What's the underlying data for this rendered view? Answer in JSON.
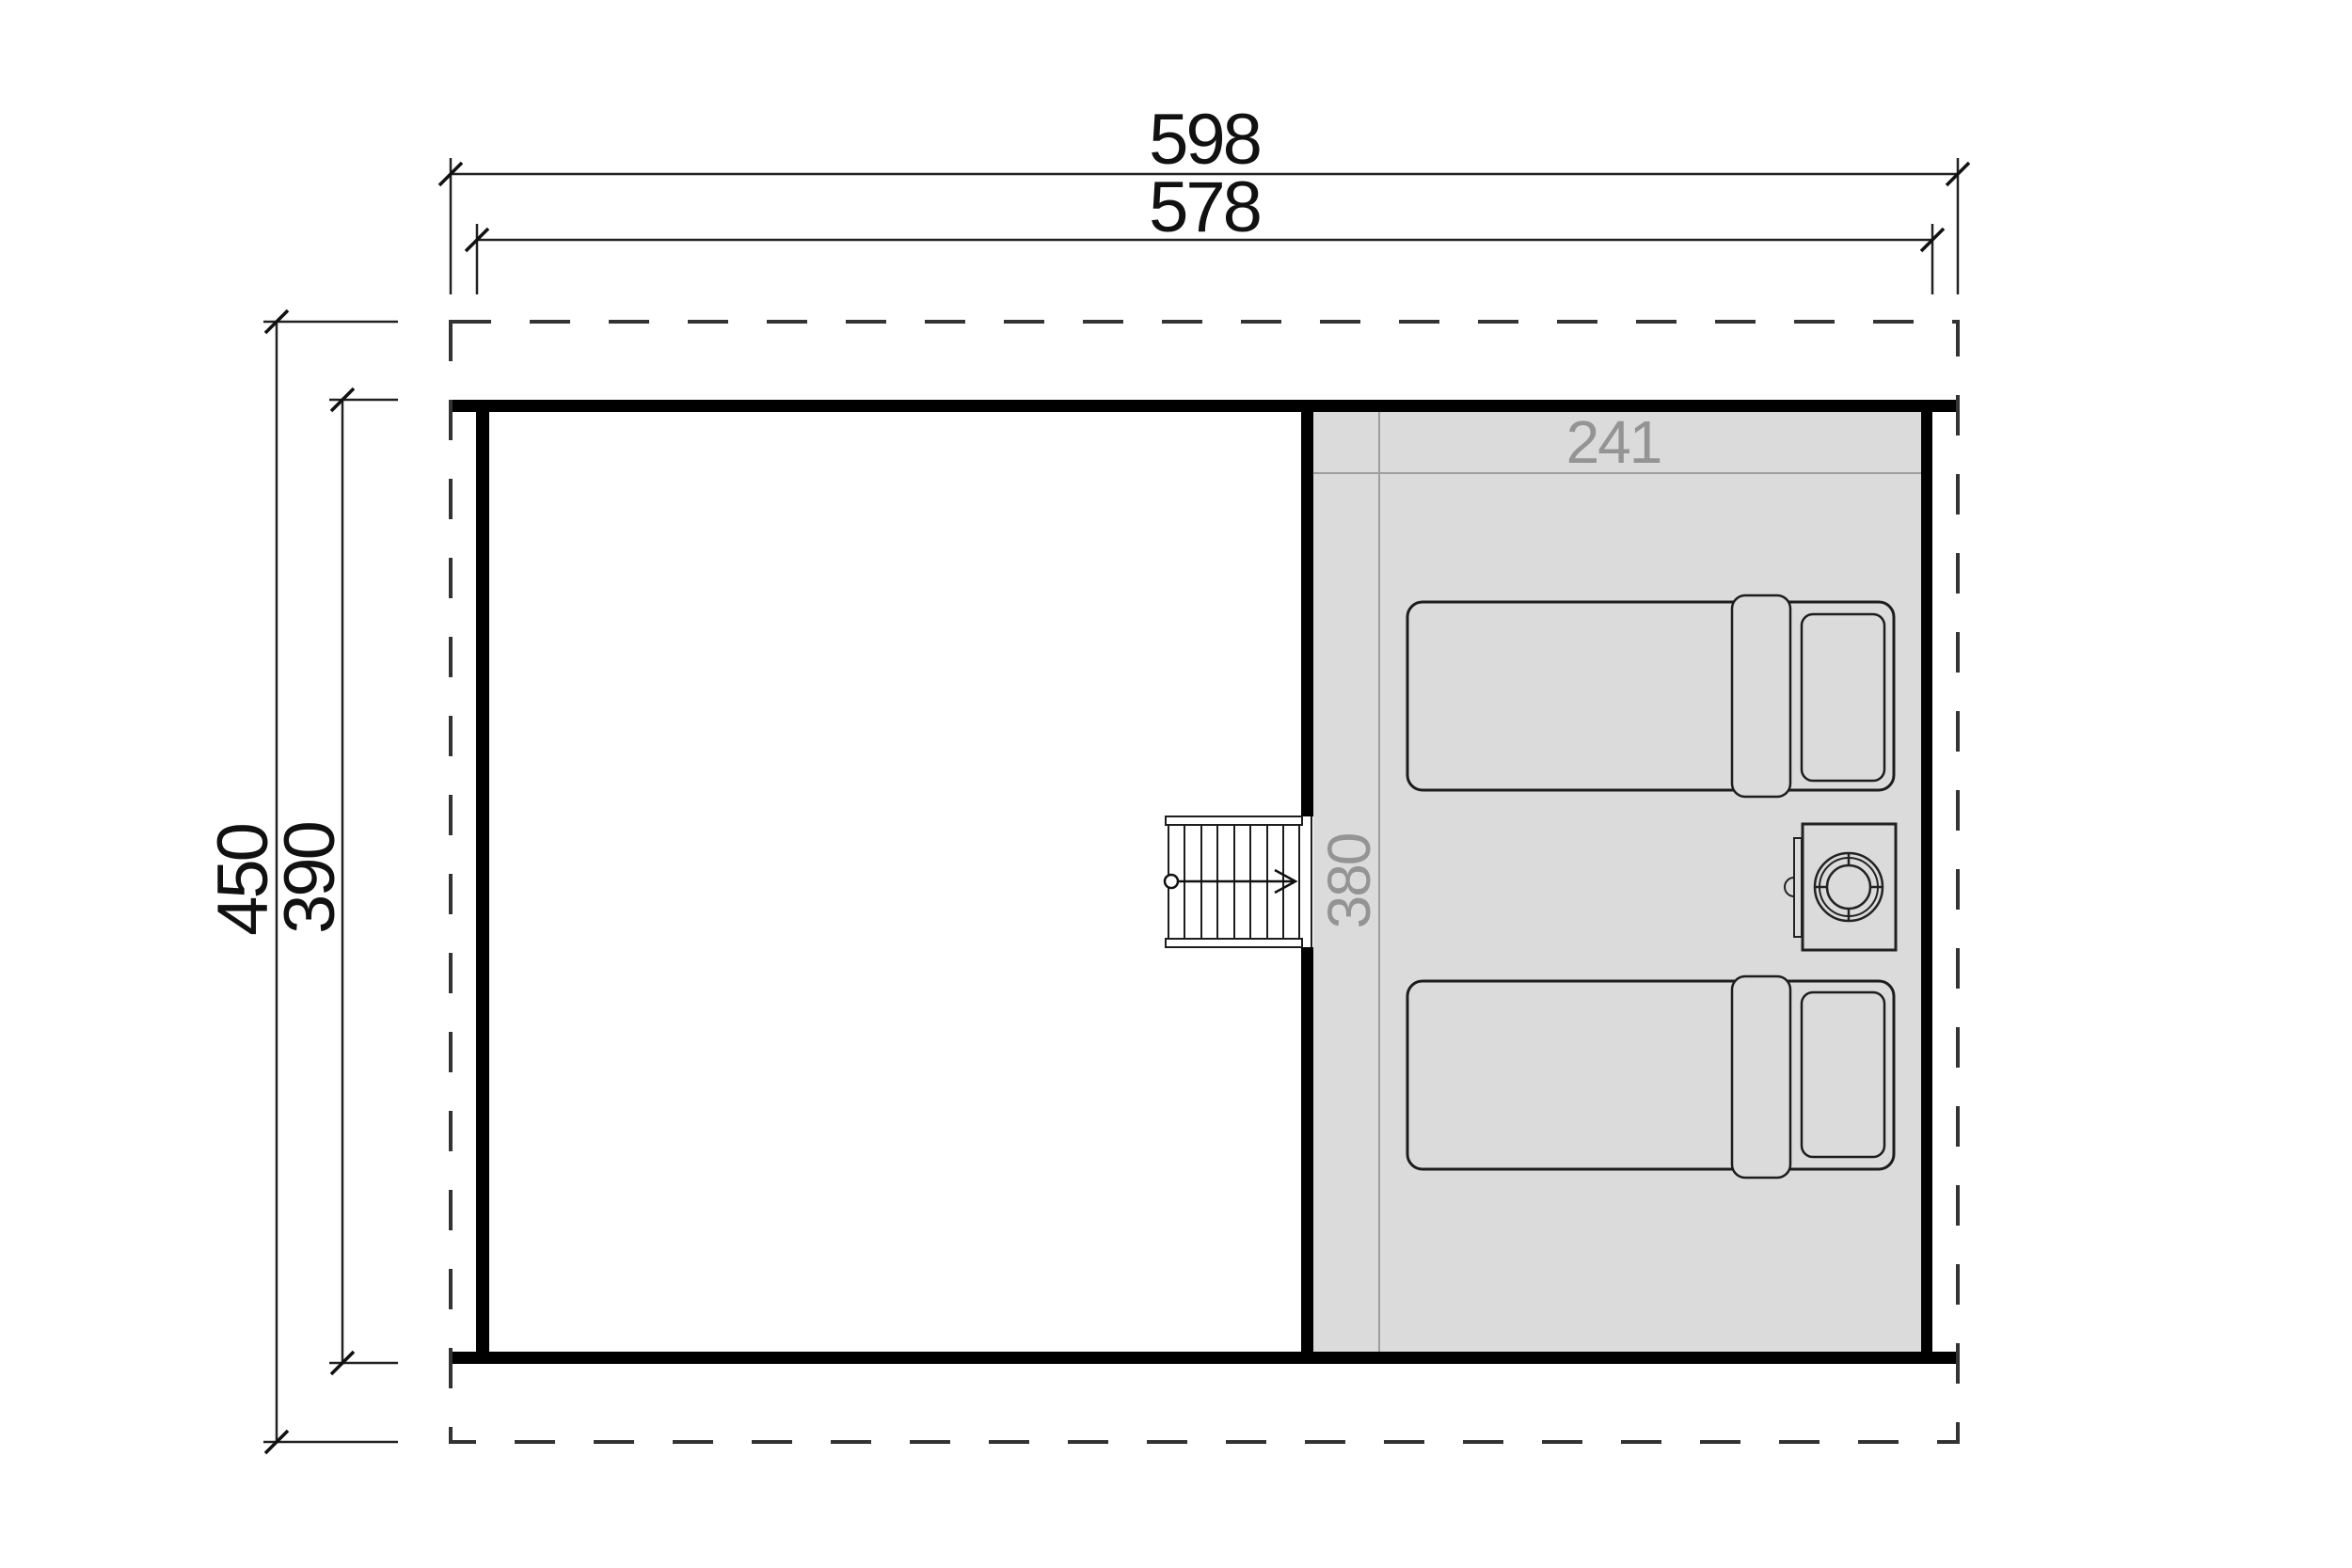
{
  "plan": {
    "dimensions": {
      "overall_width": "598",
      "wall_width": "578",
      "overall_depth": "450",
      "wall_depth": "390",
      "loft_room_width": "241",
      "loft_room_depth": "380"
    },
    "colors": {
      "wall": "#000000",
      "room_fill": "#dbdbdb",
      "outline": "#1d1d1d",
      "inner_dimension": "#949494",
      "roof_dash": "#333333"
    }
  }
}
